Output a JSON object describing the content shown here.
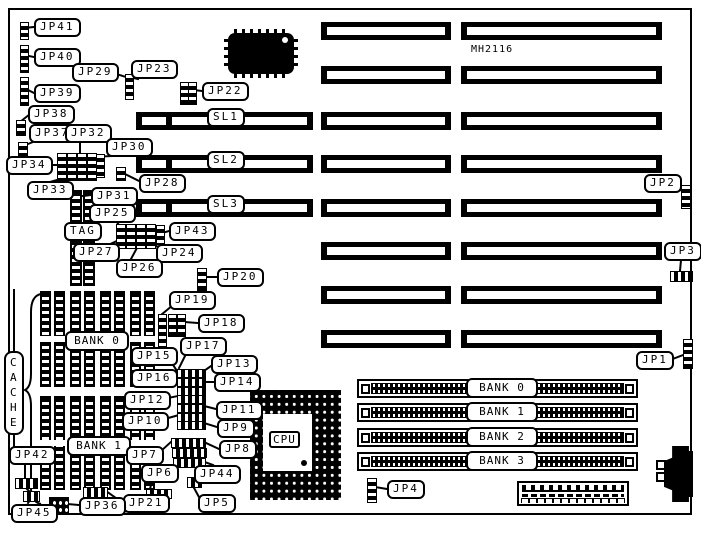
{
  "board": {
    "chip_label": "MH2116",
    "cpu_label": "CPU",
    "cache_label": "CACHE",
    "slot_rows": [
      {
        "y": 22,
        "sl": ""
      },
      {
        "y": 66,
        "sl": ""
      },
      {
        "y": 112,
        "sl": "SL1"
      },
      {
        "y": 155,
        "sl": "SL2"
      },
      {
        "y": 199,
        "sl": "SL3"
      },
      {
        "y": 242,
        "sl": ""
      },
      {
        "y": 286,
        "sl": ""
      },
      {
        "y": 330,
        "sl": ""
      }
    ],
    "simm_banks": [
      {
        "label": "BANK 0",
        "y": 379
      },
      {
        "label": "BANK 1",
        "y": 403
      },
      {
        "label": "BANK 2",
        "y": 428
      },
      {
        "label": "BANK 3",
        "y": 452
      }
    ],
    "cache_banks": [
      {
        "label": "BANK 0",
        "x": 65,
        "y": 331,
        "row_y": 291,
        "row_h": 96
      },
      {
        "label": "BANK 1",
        "x": 67,
        "y": 436,
        "row_y": 396,
        "row_h": 94
      }
    ],
    "callouts": [
      {
        "text": "JP41",
        "x": 34,
        "y": 18
      },
      {
        "text": "JP40",
        "x": 34,
        "y": 48
      },
      {
        "text": "JP29",
        "x": 72,
        "y": 63
      },
      {
        "text": "JP23",
        "x": 131,
        "y": 60
      },
      {
        "text": "JP22",
        "x": 202,
        "y": 82
      },
      {
        "text": "JP39",
        "x": 34,
        "y": 84
      },
      {
        "text": "JP38",
        "x": 28,
        "y": 105
      },
      {
        "text": "JP37",
        "x": 29,
        "y": 124
      },
      {
        "text": "JP32",
        "x": 65,
        "y": 124
      },
      {
        "text": "JP30",
        "x": 106,
        "y": 138
      },
      {
        "text": "JP34",
        "x": 6,
        "y": 156
      },
      {
        "text": "JP33",
        "x": 27,
        "y": 181
      },
      {
        "text": "JP28",
        "x": 139,
        "y": 174
      },
      {
        "text": "JP31",
        "x": 91,
        "y": 187
      },
      {
        "text": "JP25",
        "x": 89,
        "y": 204
      },
      {
        "text": "TAG",
        "x": 64,
        "y": 222
      },
      {
        "text": "JP43",
        "x": 169,
        "y": 222
      },
      {
        "text": "JP27",
        "x": 73,
        "y": 243
      },
      {
        "text": "JP24",
        "x": 156,
        "y": 244
      },
      {
        "text": "JP26",
        "x": 116,
        "y": 259
      },
      {
        "text": "JP20",
        "x": 217,
        "y": 268
      },
      {
        "text": "JP19",
        "x": 169,
        "y": 291
      },
      {
        "text": "JP18",
        "x": 198,
        "y": 314
      },
      {
        "text": "JP17",
        "x": 180,
        "y": 337
      },
      {
        "text": "JP15",
        "x": 131,
        "y": 347
      },
      {
        "text": "JP13",
        "x": 211,
        "y": 355
      },
      {
        "text": "JP16",
        "x": 131,
        "y": 369
      },
      {
        "text": "JP14",
        "x": 214,
        "y": 373
      },
      {
        "text": "JP12",
        "x": 124,
        "y": 391
      },
      {
        "text": "JP11",
        "x": 216,
        "y": 401
      },
      {
        "text": "JP10",
        "x": 122,
        "y": 412
      },
      {
        "text": "JP9",
        "x": 217,
        "y": 419
      },
      {
        "text": "JP8",
        "x": 219,
        "y": 440
      },
      {
        "text": "JP7",
        "x": 126,
        "y": 446
      },
      {
        "text": "JP6",
        "x": 141,
        "y": 464
      },
      {
        "text": "JP44",
        "x": 194,
        "y": 465
      },
      {
        "text": "JP5",
        "x": 198,
        "y": 494
      },
      {
        "text": "JP21",
        "x": 123,
        "y": 494
      },
      {
        "text": "JP36",
        "x": 79,
        "y": 497
      },
      {
        "text": "JP42",
        "x": 9,
        "y": 446
      },
      {
        "text": "JP45",
        "x": 11,
        "y": 504
      },
      {
        "text": "JP4",
        "x": 387,
        "y": 480
      },
      {
        "text": "JP2",
        "x": 644,
        "y": 174
      },
      {
        "text": "JP3",
        "x": 664,
        "y": 242
      },
      {
        "text": "JP1",
        "x": 636,
        "y": 351
      }
    ],
    "jumpers": [
      {
        "t": "v",
        "x": 20,
        "y": 22,
        "w": 7,
        "h": 16
      },
      {
        "t": "v",
        "x": 20,
        "y": 45,
        "w": 7,
        "h": 26
      },
      {
        "t": "v",
        "x": 20,
        "y": 77,
        "w": 7,
        "h": 27
      },
      {
        "t": "v",
        "x": 16,
        "y": 120,
        "w": 8,
        "h": 14
      },
      {
        "t": "v",
        "x": 18,
        "y": 142,
        "w": 8,
        "h": 16
      },
      {
        "t": "v",
        "x": 57,
        "y": 153,
        "w": 8,
        "h": 26
      },
      {
        "t": "v",
        "x": 67,
        "y": 153,
        "w": 8,
        "h": 26
      },
      {
        "t": "v",
        "x": 77,
        "y": 153,
        "w": 8,
        "h": 26
      },
      {
        "t": "v",
        "x": 87,
        "y": 153,
        "w": 8,
        "h": 26
      },
      {
        "t": "v",
        "x": 96,
        "y": 154,
        "w": 7,
        "h": 22
      },
      {
        "t": "v",
        "x": 125,
        "y": 74,
        "w": 7,
        "h": 24
      },
      {
        "t": "v",
        "x": 180,
        "y": 82,
        "w": 7,
        "h": 21
      },
      {
        "t": "v",
        "x": 188,
        "y": 82,
        "w": 7,
        "h": 21
      },
      {
        "t": "v",
        "x": 116,
        "y": 167,
        "w": 8,
        "h": 12
      },
      {
        "t": "v",
        "x": 116,
        "y": 224,
        "w": 8,
        "h": 23
      },
      {
        "t": "v",
        "x": 126,
        "y": 224,
        "w": 8,
        "h": 23
      },
      {
        "t": "v",
        "x": 136,
        "y": 224,
        "w": 8,
        "h": 23
      },
      {
        "t": "v",
        "x": 146,
        "y": 224,
        "w": 8,
        "h": 23
      },
      {
        "t": "v",
        "x": 156,
        "y": 225,
        "w": 7,
        "h": 18
      },
      {
        "t": "v",
        "x": 197,
        "y": 268,
        "w": 8,
        "h": 21
      },
      {
        "t": "v",
        "x": 158,
        "y": 314,
        "w": 7,
        "h": 33
      },
      {
        "t": "v",
        "x": 168,
        "y": 314,
        "w": 7,
        "h": 21
      },
      {
        "t": "v",
        "x": 177,
        "y": 314,
        "w": 7,
        "h": 21
      },
      {
        "t": "h",
        "x": 177,
        "y": 369,
        "w": 27,
        "h": 7
      },
      {
        "t": "h",
        "x": 177,
        "y": 378,
        "w": 27,
        "h": 7
      },
      {
        "t": "h",
        "x": 177,
        "y": 387,
        "w": 27,
        "h": 7
      },
      {
        "t": "h",
        "x": 177,
        "y": 395,
        "w": 27,
        "h": 7
      },
      {
        "t": "h",
        "x": 177,
        "y": 404,
        "w": 27,
        "h": 7
      },
      {
        "t": "h",
        "x": 177,
        "y": 413,
        "w": 27,
        "h": 7
      },
      {
        "t": "h",
        "x": 177,
        "y": 421,
        "w": 27,
        "h": 7
      },
      {
        "t": "h",
        "x": 171,
        "y": 438,
        "w": 33,
        "h": 8
      },
      {
        "t": "h",
        "x": 172,
        "y": 448,
        "w": 33,
        "h": 8
      },
      {
        "t": "h",
        "x": 173,
        "y": 458,
        "w": 31,
        "h": 8
      },
      {
        "t": "h",
        "x": 187,
        "y": 477,
        "w": 13,
        "h": 9
      },
      {
        "t": "h",
        "x": 146,
        "y": 489,
        "w": 24,
        "h": 8
      },
      {
        "t": "h",
        "x": 83,
        "y": 487,
        "w": 23,
        "h": 9
      },
      {
        "t": "h",
        "x": 15,
        "y": 478,
        "w": 21,
        "h": 9
      },
      {
        "t": "h",
        "x": 23,
        "y": 491,
        "w": 15,
        "h": 9
      },
      {
        "t": "g",
        "x": 49,
        "y": 497,
        "w": 18,
        "h": 14
      },
      {
        "t": "v",
        "x": 367,
        "y": 478,
        "w": 8,
        "h": 23
      },
      {
        "t": "v",
        "x": 681,
        "y": 185,
        "w": 8,
        "h": 22
      },
      {
        "t": "h",
        "x": 670,
        "y": 271,
        "w": 21,
        "h": 9
      },
      {
        "t": "v",
        "x": 683,
        "y": 339,
        "w": 8,
        "h": 28
      }
    ],
    "connectors": [
      [
        34,
        27,
        24,
        28
      ],
      [
        34,
        57,
        24,
        55
      ],
      [
        34,
        93,
        24,
        88
      ],
      [
        30,
        114,
        20,
        122
      ],
      [
        33,
        142,
        23,
        146
      ],
      [
        80,
        142,
        80,
        153
      ],
      [
        112,
        156,
        93,
        157
      ],
      [
        44,
        165,
        57,
        165
      ],
      [
        50,
        182,
        64,
        178
      ],
      [
        110,
        72,
        126,
        77
      ],
      [
        138,
        79,
        129,
        77
      ],
      [
        202,
        91,
        194,
        90
      ],
      [
        139,
        181,
        121,
        172
      ],
      [
        91,
        195,
        83,
        196
      ],
      [
        113,
        217,
        119,
        225
      ],
      [
        169,
        231,
        162,
        233
      ],
      [
        106,
        246,
        119,
        240
      ],
      [
        158,
        247,
        150,
        242
      ],
      [
        131,
        259,
        138,
        246
      ],
      [
        217,
        277,
        206,
        277
      ],
      [
        173,
        305,
        161,
        315
      ],
      [
        198,
        323,
        184,
        322
      ],
      [
        186,
        354,
        179,
        368
      ],
      [
        168,
        357,
        177,
        371
      ],
      [
        211,
        366,
        201,
        373
      ],
      [
        168,
        379,
        178,
        381
      ],
      [
        214,
        382,
        204,
        382
      ],
      [
        163,
        399,
        178,
        396
      ],
      [
        216,
        409,
        204,
        406
      ],
      [
        161,
        420,
        179,
        415
      ],
      [
        217,
        427,
        204,
        423
      ],
      [
        219,
        449,
        206,
        443
      ],
      [
        160,
        452,
        172,
        441
      ],
      [
        152,
        481,
        150,
        489
      ],
      [
        213,
        465,
        202,
        461
      ],
      [
        200,
        499,
        193,
        486
      ],
      [
        123,
        503,
        106,
        491
      ],
      [
        79,
        505,
        67,
        504
      ],
      [
        25,
        464,
        25,
        477
      ],
      [
        30,
        492,
        26,
        488
      ],
      [
        28,
        503,
        30,
        500
      ],
      [
        14,
        290,
        14,
        351
      ],
      [
        14,
        435,
        14,
        446
      ],
      [
        387,
        489,
        375,
        487
      ],
      [
        678,
        188,
        682,
        191
      ],
      [
        681,
        260,
        680,
        271
      ],
      [
        670,
        360,
        683,
        355
      ]
    ]
  }
}
